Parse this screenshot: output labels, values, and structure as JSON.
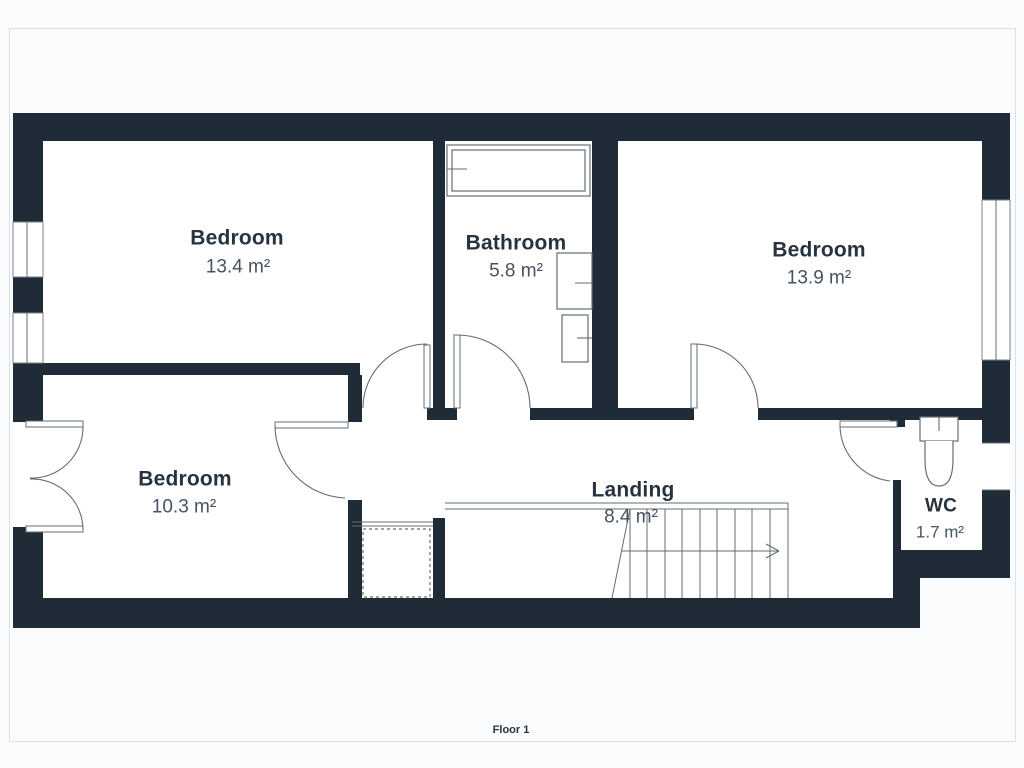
{
  "floor_plan": {
    "floor_label": "Floor 1",
    "rooms": [
      {
        "id": "bedroom-top-left",
        "name": "Bedroom",
        "area": "13.4 m²"
      },
      {
        "id": "bathroom",
        "name": "Bathroom",
        "area": "5.8 m²"
      },
      {
        "id": "bedroom-right",
        "name": "Bedroom",
        "area": "13.9 m²"
      },
      {
        "id": "bedroom-bottom-left",
        "name": "Bedroom",
        "area": "10.3 m²"
      },
      {
        "id": "landing",
        "name": "Landing",
        "area": "8.4 m²"
      },
      {
        "id": "wc",
        "name": "WC",
        "area": "1.7 m²"
      }
    ],
    "fixtures": [
      "bathtub-icon",
      "sink-icon",
      "toilet-icon",
      "toilet-icon",
      "staircase",
      "storage-dashed-box"
    ],
    "colors": {
      "wall": "#1f2b37",
      "line": "#636d75",
      "name_text": "#273440",
      "area_text": "#475360",
      "floor": "#ffffff",
      "background": "#fafbfc",
      "frame": "#dcdfe3"
    }
  }
}
